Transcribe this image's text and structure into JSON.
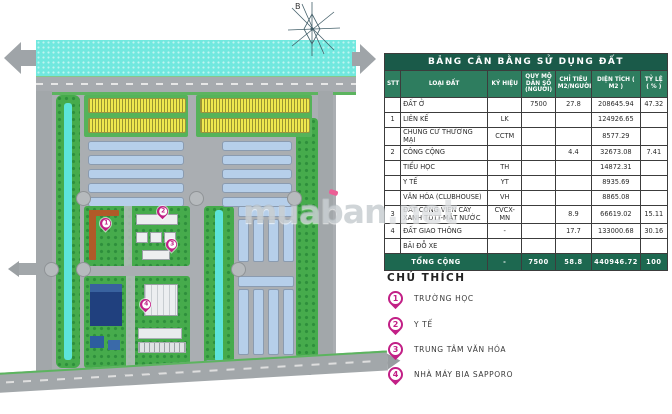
{
  "table": {
    "title": "BẢNG CÂN BẰNG SỬ DỤNG ĐẤT",
    "columns": [
      "STT",
      "LOẠI ĐẤT",
      "KÝ HIỆU",
      "QUY MÔ DÂN SỐ (NGƯỜI)",
      "CHỈ TIÊU M2/NGƯỜI",
      "DIỆN TÍCH ( M2 )",
      "TỶ LỆ ( % )"
    ],
    "rows": [
      [
        "",
        "ĐẤT Ở",
        "",
        "7500",
        "27.8",
        "208645.94",
        "47.32"
      ],
      [
        "1",
        "LIÊN KẾ",
        "LK",
        "",
        "",
        "124926.65",
        ""
      ],
      [
        "",
        "CHUNG CƯ THƯƠNG MẠI",
        "CCTM",
        "",
        "",
        "8577.29",
        ""
      ],
      [
        "2",
        "CÔNG CỘNG",
        "",
        "",
        "4.4",
        "32673.08",
        "7.41"
      ],
      [
        "",
        "TIỂU HỌC",
        "TH",
        "",
        "",
        "14872.31",
        ""
      ],
      [
        "",
        "Y TẾ",
        "YT",
        "",
        "",
        "8935.69",
        ""
      ],
      [
        "",
        "VĂN HÓA (CLUBHOUSE)",
        "VH",
        "",
        "",
        "8865.08",
        ""
      ],
      [
        "3",
        "ĐẤT CÔNG VIÊN CÂY XANH TDTT-MẶT NƯỚC",
        "CVCX-MN",
        "",
        "8.9",
        "66619.02",
        "15.11"
      ],
      [
        "4",
        "ĐẤT GIAO THÔNG",
        "-",
        "",
        "17.7",
        "133000.68",
        "30.16"
      ],
      [
        "",
        "BÃI ĐỖ XE",
        "",
        "",
        "",
        "",
        ""
      ]
    ],
    "total": [
      "TỔNG CỘNG",
      "-",
      "7500",
      "58.8",
      "440946.72",
      "100"
    ]
  },
  "legend": {
    "title": "CHÚ THÍCH",
    "items": [
      {
        "n": "1",
        "label": "TRƯỜNG HỌC"
      },
      {
        "n": "2",
        "label": "Y TẾ"
      },
      {
        "n": "3",
        "label": "TRUNG TÂM VĂN HÓA"
      },
      {
        "n": "4",
        "label": "NHÀ MÁY BIA SAPPORO"
      }
    ]
  },
  "map": {
    "compass_label": "B",
    "pins": [
      {
        "n": "1"
      },
      {
        "n": "2"
      },
      {
        "n": "3"
      },
      {
        "n": "4"
      }
    ]
  },
  "watermark": {
    "part1": "muaban",
    "part2": ".net"
  },
  "colors": {
    "pin": "#c21f86",
    "table_title_bg": "#1a5a49",
    "table_header_bg": "#2e7d5f",
    "table_total_bg": "#1d6850",
    "water": "#71e8df",
    "park_green": "#46ab4c",
    "housing_blue": "#b6cfea",
    "housing_yellow": "#efe84e",
    "road_gray": "#a2a7aa"
  }
}
